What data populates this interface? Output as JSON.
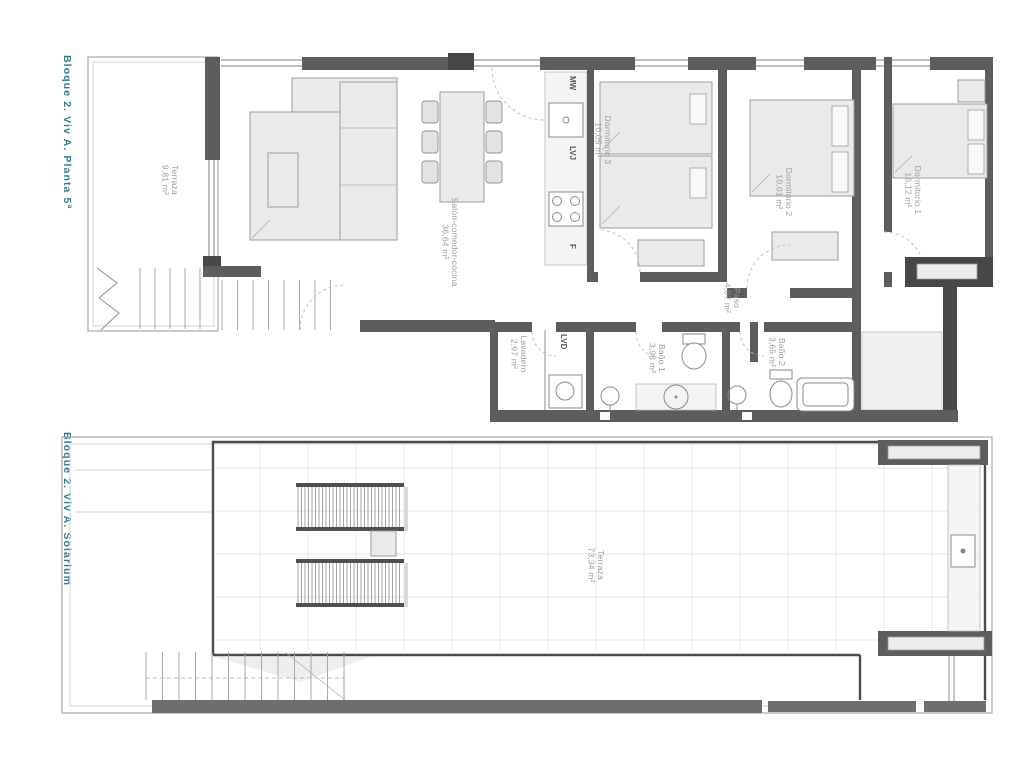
{
  "colors": {
    "accent_teal": "#2f7b90",
    "wall_dark": "#5d5d5d",
    "wall_darker": "#474747",
    "label_gray": "#9b9b9b",
    "furniture_fill": "#eaeaea"
  },
  "planta5": {
    "side_label": "Bloque 2. Viv A. Planta 5ª",
    "rooms": {
      "terraza": {
        "name": "Terraza",
        "area": "9,81 m²"
      },
      "salon": {
        "name": "Salón-comedor-cocina",
        "area": "36,64 m²"
      },
      "dorm3": {
        "name": "Dormitorio 3",
        "area": "10,05 m²"
      },
      "dorm2": {
        "name": "Dormitorio 2",
        "area": "10,01 m²"
      },
      "dorm1": {
        "name": "Dormitorio 1",
        "area": "16,12 m²"
      },
      "paso": {
        "name": "Paso",
        "area": "4,07 m²"
      },
      "lavadero": {
        "name": "Lavadero",
        "area": "2,97 m²"
      },
      "bano1": {
        "name": "Baño 1",
        "area": "3,98 m²"
      },
      "bano2": {
        "name": "Baño 2",
        "area": "3,65 m²"
      }
    },
    "appliances": {
      "microwave": "MW",
      "dishwasher": "LVJ",
      "washer": "LVD",
      "fridge": "F"
    }
  },
  "solarium": {
    "side_label": "Bloque 2. Viv A. Solarium",
    "rooms": {
      "terraza": {
        "name": "Terraza",
        "area": "73,34 m²"
      }
    }
  }
}
